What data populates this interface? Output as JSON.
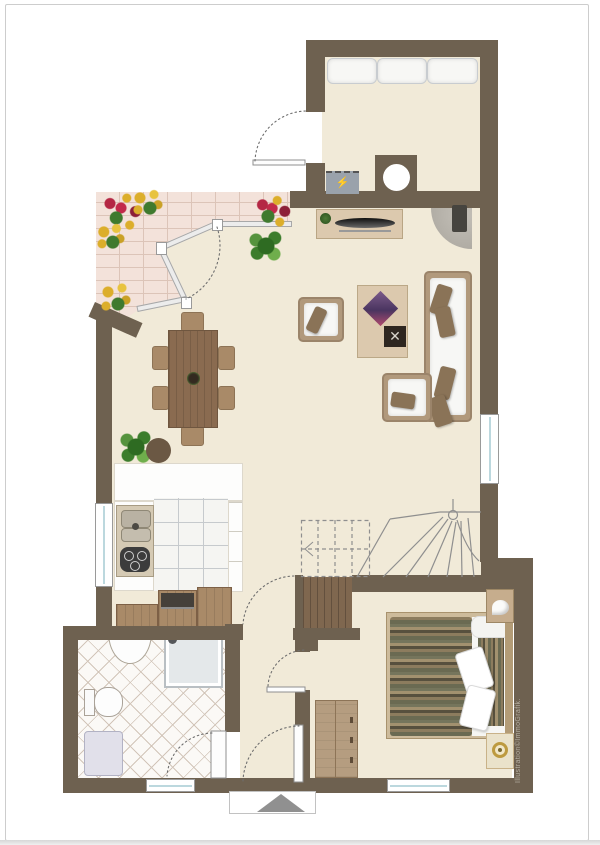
{
  "watermark": "Illustration©ImmoGrafik.",
  "palette": {
    "wall": "#6e6150",
    "floor": "#f1ead8",
    "brick": "#f3e2da",
    "brick_line": "#dcc4b8",
    "tile_line": "#d2c5b9",
    "ktile_line": "#c6cacd",
    "stair_line": "#8f8f8f",
    "wood_mid": "#a98a68",
    "wood_light": "#dcc9ae",
    "wicker": "#b1997c",
    "pillow": "#8a7357",
    "duvet_stripe_a": "#6a6a52",
    "duvet_stripe_b": "#a2916f"
  },
  "symbols": {
    "electrical_panel_glyph": "⚡",
    "wine_rack_glyph": "✕"
  }
}
